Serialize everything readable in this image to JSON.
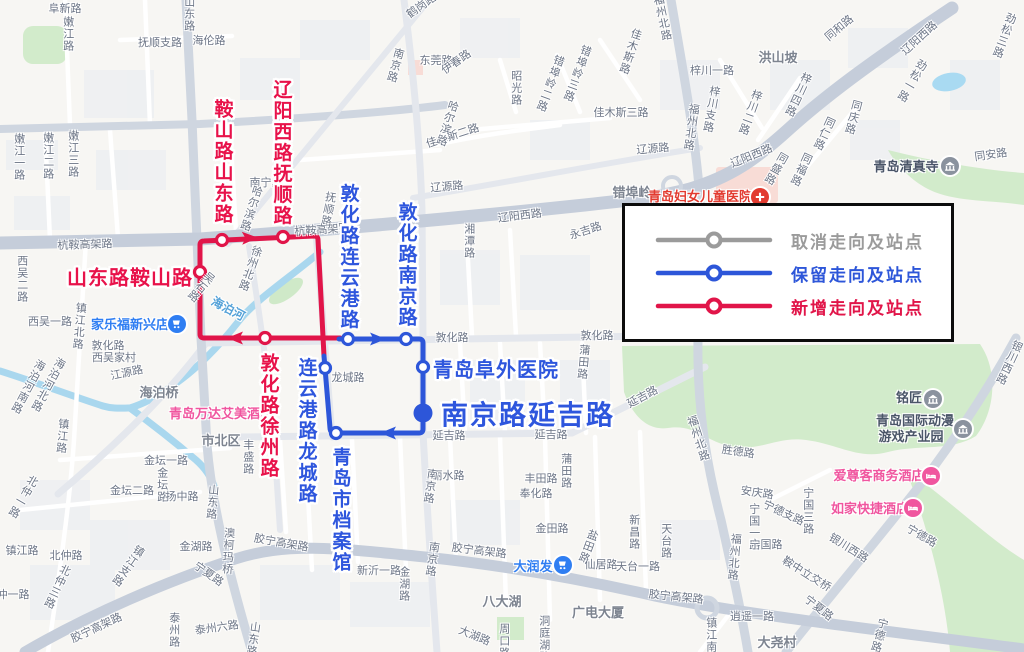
{
  "legend": {
    "items": [
      {
        "label": "取消走向及站点",
        "color": "#9b9b9b"
      },
      {
        "label": "保留走向及站点",
        "color": "#2d56d9"
      },
      {
        "label": "新增走向及站点",
        "color": "#e11549"
      }
    ]
  },
  "routes": {
    "kept": {
      "name": "保留走向",
      "color": "#2d56d9",
      "paths": [
        "M339,339 L419,339 Q423,339 423,343 L423,429 Q423,433 419,433 L336,433 Q330,433 330,428 L324,356"
      ],
      "stations": [
        [
          348,
          339
        ],
        [
          406,
          339
        ],
        [
          423,
          367
        ],
        [
          336,
          433
        ],
        [
          325,
          368
        ]
      ],
      "arrows": [
        {
          "x": 377,
          "y": 339,
          "a": 0
        },
        {
          "x": 389,
          "y": 433,
          "a": 180
        }
      ],
      "terminus": {
        "x": 423,
        "y": 413,
        "r": 9.5
      }
    },
    "added": {
      "name": "新增走向",
      "color": "#e11549",
      "paths": [
        "M340,338 L204,338 Q200,338 200,334 L200,245 Q200,241 204,241 L314,236 Q318,236 318,240 L324,356"
      ],
      "stations": [
        [
          222,
          240
        ],
        [
          283,
          237
        ],
        [
          200,
          272
        ],
        [
          265,
          338
        ]
      ],
      "arrows": [
        {
          "x": 249,
          "y": 238,
          "a": -2
        },
        {
          "x": 236,
          "y": 338,
          "a": 180
        }
      ],
      "terminus": null
    }
  },
  "route_labels": [
    {
      "t": "鞍山路山东路",
      "x": 222,
      "y": 162,
      "mode": "v",
      "cls": "red"
    },
    {
      "t": "辽阳西路抚顺路",
      "x": 281,
      "y": 153,
      "mode": "v",
      "cls": "red"
    },
    {
      "t": "山东路鞍山路",
      "x": 130,
      "y": 276,
      "mode": "h",
      "cls": "red"
    },
    {
      "t": "敦化路徐州路",
      "x": 268,
      "y": 416,
      "mode": "v",
      "cls": "red"
    },
    {
      "t": "敦化路连云港路",
      "x": 348,
      "y": 257,
      "mode": "v",
      "cls": "blue"
    },
    {
      "t": "敦化路南京路",
      "x": 406,
      "y": 265,
      "mode": "v",
      "cls": "blue"
    },
    {
      "t": "连云港路龙城路",
      "x": 306,
      "y": 431,
      "mode": "v",
      "cls": "blue"
    },
    {
      "t": "青岛市档案馆",
      "x": 340,
      "y": 510,
      "mode": "v",
      "cls": "blue"
    },
    {
      "t": "青岛阜外医院",
      "x": 496,
      "y": 368,
      "mode": "h",
      "cls": "blue"
    },
    {
      "t": "南京路延吉路",
      "x": 528,
      "y": 413,
      "mode": "h",
      "cls": "blue xl"
    }
  ],
  "pois": [
    {
      "t": "家乐福新兴店",
      "x": 130,
      "y": 325,
      "cls": "poi-blue",
      "icon": "cart-icon",
      "ix": 177,
      "iy": 324,
      "ibg": "#2f7ef2"
    },
    {
      "t": "大润发",
      "x": 533,
      "y": 567,
      "cls": "poi-blue",
      "icon": "cart-icon",
      "ix": 563,
      "iy": 565,
      "ibg": "#2f7ef2"
    },
    {
      "t": "青岛万达艾美酒店",
      "x": 221,
      "y": 414,
      "cls": "poi-pink"
    },
    {
      "t": "爱尊客商务酒店",
      "x": 879,
      "y": 476,
      "cls": "poi-pink",
      "icon": "hotel-icon",
      "ix": 931,
      "iy": 476,
      "ibg": "#f0569f"
    },
    {
      "t": "如家快捷酒店",
      "x": 870,
      "y": 509,
      "cls": "poi-pink",
      "icon": "hotel-icon",
      "ix": 913,
      "iy": 508,
      "ibg": "#f0569f"
    },
    {
      "t": "青岛妇女儿童医院",
      "x": 700,
      "y": 197,
      "cls": "poi-red",
      "icon": "hospital-icon",
      "ix": 760,
      "iy": 197,
      "ibg": "#e23b30"
    },
    {
      "t": "青岛清真寺",
      "x": 906,
      "y": 167,
      "cls": "poi-dark",
      "icon": "landmark-icon",
      "ix": 950,
      "iy": 166,
      "ibg": "#8a929e"
    },
    {
      "t": "铭匠",
      "x": 909,
      "y": 398,
      "cls": "poi-dark",
      "icon": "landmark-icon",
      "ix": 933,
      "iy": 399,
      "ibg": "#8a929e"
    },
    {
      "t": "青岛国际动漫",
      "x": 915,
      "y": 421,
      "cls": "poi-dark",
      "icon": "landmark-icon",
      "ix": 963,
      "iy": 429,
      "ibg": "#8a929e"
    },
    {
      "t": "游戏产业园",
      "x": 911,
      "y": 437,
      "cls": "poi-dark"
    }
  ],
  "map_labels": [
    {
      "t": "阜新路",
      "x": 65,
      "y": 10,
      "m": "h",
      "r": 0
    },
    {
      "t": "嫩江路",
      "x": 67,
      "y": 34,
      "m": "v",
      "r": 0
    },
    {
      "t": "山东路",
      "x": 188,
      "y": 14,
      "m": "v",
      "r": 0
    },
    {
      "t": "抚顺支路",
      "x": 160,
      "y": 44,
      "m": "h",
      "r": 0
    },
    {
      "t": "海伦路",
      "x": 209,
      "y": 42,
      "m": "h",
      "r": 0
    },
    {
      "t": "鹤岗路",
      "x": 422,
      "y": 7,
      "m": "h",
      "r": -35
    },
    {
      "t": "福州北路",
      "x": 661,
      "y": 18,
      "m": "v",
      "r": -12
    },
    {
      "t": "劲松三路",
      "x": 1003,
      "y": 35,
      "m": "v",
      "r": 20
    },
    {
      "t": "同和路",
      "x": 840,
      "y": 29,
      "m": "h",
      "r": -40
    },
    {
      "t": "辽阳西路",
      "x": 920,
      "y": 39,
      "m": "h",
      "r": -42
    },
    {
      "t": "梓川一路",
      "x": 712,
      "y": 72,
      "m": "h",
      "r": 0
    },
    {
      "t": "洪山坡",
      "x": 778,
      "y": 58,
      "m": "h",
      "r": 0,
      "cls": "big"
    },
    {
      "t": "梓川四路",
      "x": 797,
      "y": 94,
      "m": "v",
      "r": 25
    },
    {
      "t": "梓川支路",
      "x": 710,
      "y": 109,
      "m": "v",
      "r": 10
    },
    {
      "t": "梓川二路",
      "x": 749,
      "y": 112,
      "m": "v",
      "r": 20
    },
    {
      "t": "福州北路",
      "x": 690,
      "y": 127,
      "m": "v",
      "r": 8
    },
    {
      "t": "劲松一路",
      "x": 911,
      "y": 80,
      "m": "v",
      "r": 30
    },
    {
      "t": "错埠岭",
      "x": 632,
      "y": 193,
      "m": "h",
      "r": 0,
      "cls": "big"
    },
    {
      "t": "辽阳西路",
      "x": 752,
      "y": 157,
      "m": "h",
      "r": -22
    },
    {
      "t": "同庆路",
      "x": 852,
      "y": 117,
      "m": "v",
      "r": 15
    },
    {
      "t": "同仁路",
      "x": 823,
      "y": 133,
      "m": "v",
      "r": 25
    },
    {
      "t": "同安路",
      "x": 991,
      "y": 156,
      "m": "h",
      "r": -8
    },
    {
      "t": "同盛路",
      "x": 775,
      "y": 168,
      "m": "v",
      "r": 30
    },
    {
      "t": "同福路",
      "x": 800,
      "y": 169,
      "m": "v",
      "r": 25
    },
    {
      "t": "永吉路",
      "x": 586,
      "y": 232,
      "m": "h",
      "r": -18
    },
    {
      "t": "辽源路",
      "x": 447,
      "y": 188,
      "m": "h",
      "r": -5
    },
    {
      "t": "辽源路",
      "x": 653,
      "y": 150,
      "m": "h",
      "r": -5
    },
    {
      "t": "湘潭路",
      "x": 468,
      "y": 241,
      "m": "v",
      "r": 0
    },
    {
      "t": "东莞路",
      "x": 436,
      "y": 62,
      "m": "h",
      "r": 0
    },
    {
      "t": "南京路",
      "x": 394,
      "y": 65,
      "m": "v",
      "r": 15
    },
    {
      "t": "错埠岭三路",
      "x": 576,
      "y": 73,
      "m": "v",
      "r": 20
    },
    {
      "t": "错埠岭二路",
      "x": 549,
      "y": 83,
      "m": "v",
      "r": 20
    },
    {
      "t": "佳木斯路",
      "x": 629,
      "y": 51,
      "m": "v",
      "r": 18
    },
    {
      "t": "佳木斯三路",
      "x": 621,
      "y": 114,
      "m": "h",
      "r": 0
    },
    {
      "t": "佳木斯二路",
      "x": 453,
      "y": 137,
      "m": "h",
      "r": -18
    },
    {
      "t": "昭光路",
      "x": 515,
      "y": 88,
      "m": "v",
      "r": 0
    },
    {
      "t": "伊春路",
      "x": 457,
      "y": 63,
      "m": "h",
      "r": -35
    },
    {
      "t": "南宁路",
      "x": 266,
      "y": 184,
      "m": "h",
      "r": 0
    },
    {
      "t": "抚顺路",
      "x": 327,
      "y": 209,
      "m": "v",
      "r": 10
    },
    {
      "t": "哈尔滨路",
      "x": 250,
      "y": 208,
      "m": "v",
      "r": 18
    },
    {
      "t": "哈尔滨路",
      "x": 446,
      "y": 123,
      "m": "v",
      "r": 18
    },
    {
      "t": "杭鞍高架路",
      "x": 85,
      "y": 246,
      "m": "h",
      "r": -2
    },
    {
      "t": "杭鞍高架路",
      "x": 322,
      "y": 231,
      "m": "h",
      "r": -4
    },
    {
      "t": "辽阳西路",
      "x": 520,
      "y": 217,
      "m": "h",
      "r": -7
    },
    {
      "t": "敦化路",
      "x": 108,
      "y": 347,
      "m": "h",
      "r": 0
    },
    {
      "t": "西吴家村",
      "x": 114,
      "y": 359,
      "m": "h",
      "r": 0
    },
    {
      "t": "江源路",
      "x": 127,
      "y": 374,
      "m": "h",
      "r": -12
    },
    {
      "t": "海泊桥",
      "x": 159,
      "y": 393,
      "m": "h",
      "r": 0,
      "cls": "big"
    },
    {
      "t": "海泊河北路",
      "x": 47,
      "y": 384,
      "m": "v",
      "r": 28
    },
    {
      "t": "海泊河南路",
      "x": 27,
      "y": 386,
      "m": "v",
      "r": 28
    },
    {
      "t": "西吴一路",
      "x": 50,
      "y": 323,
      "m": "h",
      "r": 0
    },
    {
      "t": "西吴二路",
      "x": 21,
      "y": 279,
      "m": "v",
      "r": 0
    },
    {
      "t": "镇江北路",
      "x": 78,
      "y": 326,
      "m": "v",
      "r": 5
    },
    {
      "t": "镇江路",
      "x": 61,
      "y": 436,
      "m": "v",
      "r": 5
    },
    {
      "t": "吴石路",
      "x": 200,
      "y": 286,
      "m": "v",
      "r": 40
    },
    {
      "t": "徐州北路",
      "x": 249,
      "y": 268,
      "m": "v",
      "r": 20
    },
    {
      "t": "海泊河",
      "x": 228,
      "y": 309,
      "m": "h",
      "r": 28,
      "cls": "water"
    },
    {
      "t": "龙城路",
      "x": 348,
      "y": 379,
      "m": "h",
      "r": 0
    },
    {
      "t": "敦化路",
      "x": 452,
      "y": 339,
      "m": "h",
      "r": 0
    },
    {
      "t": "敦化路",
      "x": 597,
      "y": 337,
      "m": "h",
      "r": 0
    },
    {
      "t": "蒲田路",
      "x": 582,
      "y": 362,
      "m": "v",
      "r": 5
    },
    {
      "t": "延吉路",
      "x": 449,
      "y": 437,
      "m": "h",
      "r": 0
    },
    {
      "t": "延吉路",
      "x": 551,
      "y": 436,
      "m": "h",
      "r": 0
    },
    {
      "t": "延吉路",
      "x": 643,
      "y": 398,
      "m": "h",
      "r": -28
    },
    {
      "t": "丽水路",
      "x": 448,
      "y": 477,
      "m": "h",
      "r": 0
    },
    {
      "t": "南京路",
      "x": 429,
      "y": 486,
      "m": "v",
      "r": 8
    },
    {
      "t": "南京路",
      "x": 431,
      "y": 559,
      "m": "v",
      "r": 8
    },
    {
      "t": "胶宁高架路",
      "x": 281,
      "y": 544,
      "m": "h",
      "r": 10
    },
    {
      "t": "胶宁高架路",
      "x": 479,
      "y": 552,
      "m": "h",
      "r": 7
    },
    {
      "t": "胶宁高架路",
      "x": 676,
      "y": 598,
      "m": "h",
      "r": 6
    },
    {
      "t": "胶宁高架路",
      "x": 97,
      "y": 629,
      "m": "h",
      "r": -25
    },
    {
      "t": "澳柯玛桥",
      "x": 227,
      "y": 551,
      "m": "v",
      "r": 3
    },
    {
      "t": "宁夏路",
      "x": 208,
      "y": 575,
      "m": "h",
      "r": 35
    },
    {
      "t": "宁夏路",
      "x": 818,
      "y": 609,
      "m": "h",
      "r": 38
    },
    {
      "t": "金湖路",
      "x": 196,
      "y": 548,
      "m": "h",
      "r": 0
    },
    {
      "t": "金湖路",
      "x": 403,
      "y": 584,
      "m": "v",
      "r": 0
    },
    {
      "t": "新沂一路",
      "x": 379,
      "y": 572,
      "m": "h",
      "r": 0
    },
    {
      "t": "金坛一路",
      "x": 166,
      "y": 462,
      "m": "h",
      "r": 0
    },
    {
      "t": "金坛二路",
      "x": 132,
      "y": 492,
      "m": "h",
      "r": 0
    },
    {
      "t": "金坛路",
      "x": 161,
      "y": 485,
      "m": "v",
      "r": 0
    },
    {
      "t": "扬中路",
      "x": 182,
      "y": 498,
      "m": "h",
      "r": 0
    },
    {
      "t": "山东路",
      "x": 211,
      "y": 502,
      "m": "v",
      "r": 5
    },
    {
      "t": "山东路",
      "x": 252,
      "y": 639,
      "m": "v",
      "r": 8
    },
    {
      "t": "泰州六路",
      "x": 217,
      "y": 629,
      "m": "h",
      "r": -8
    },
    {
      "t": "泰州路",
      "x": 173,
      "y": 630,
      "m": "v",
      "r": 0
    },
    {
      "t": "镇江路",
      "x": 22,
      "y": 552,
      "m": "h",
      "r": 0
    },
    {
      "t": "北仲路",
      "x": 66,
      "y": 557,
      "m": "h",
      "r": 0
    },
    {
      "t": "北仲一路",
      "x": 22,
      "y": 496,
      "m": "v",
      "r": 30
    },
    {
      "t": "北仲三路",
      "x": 56,
      "y": 586,
      "m": "v",
      "r": 25
    },
    {
      "t": "仲一路",
      "x": 13,
      "y": 596,
      "m": "h",
      "r": 0
    },
    {
      "t": "镇江支路",
      "x": 127,
      "y": 565,
      "m": "v",
      "r": 35
    },
    {
      "t": "丰盛路",
      "x": 247,
      "y": 457,
      "m": "v",
      "r": 0
    },
    {
      "t": "市北区",
      "x": 221,
      "y": 441,
      "m": "h",
      "r": 0,
      "cls": "big"
    },
    {
      "t": "丰田路",
      "x": 541,
      "y": 480,
      "m": "h",
      "r": 0
    },
    {
      "t": "奉化路",
      "x": 536,
      "y": 495,
      "m": "h",
      "r": 0
    },
    {
      "t": "蒲田路",
      "x": 565,
      "y": 471,
      "m": "v",
      "r": 0
    },
    {
      "t": "金田路",
      "x": 552,
      "y": 530,
      "m": "h",
      "r": 0
    },
    {
      "t": "盐田路",
      "x": 587,
      "y": 546,
      "m": "v",
      "r": 20
    },
    {
      "t": "仙居路",
      "x": 601,
      "y": 566,
      "m": "h",
      "r": 0
    },
    {
      "t": "天台一路",
      "x": 638,
      "y": 568,
      "m": "h",
      "r": 0
    },
    {
      "t": "新昌路",
      "x": 633,
      "y": 532,
      "m": "v",
      "r": 0
    },
    {
      "t": "天台路",
      "x": 665,
      "y": 541,
      "m": "v",
      "r": 0
    },
    {
      "t": "八大湖",
      "x": 502,
      "y": 602,
      "m": "h",
      "r": 0,
      "cls": "big"
    },
    {
      "t": "广电大厦",
      "x": 598,
      "y": 613,
      "m": "h",
      "r": 0,
      "cls": "big"
    },
    {
      "t": "大湖路",
      "x": 474,
      "y": 637,
      "m": "h",
      "r": 22
    },
    {
      "t": "洞庭湖路",
      "x": 543,
      "y": 639,
      "m": "v",
      "r": 0
    },
    {
      "t": "周口路",
      "x": 503,
      "y": 641,
      "m": "v",
      "r": 0
    },
    {
      "t": "大尧村",
      "x": 777,
      "y": 643,
      "m": "h",
      "r": 0,
      "cls": "big"
    },
    {
      "t": "安庆路",
      "x": 757,
      "y": 494,
      "m": "h",
      "r": 8
    },
    {
      "t": "宁德支路",
      "x": 783,
      "y": 514,
      "m": "h",
      "r": 25
    },
    {
      "t": "宁国三路",
      "x": 807,
      "y": 511,
      "m": "v",
      "r": 0
    },
    {
      "t": "宁国一路",
      "x": 753,
      "y": 527,
      "m": "v",
      "r": 0
    },
    {
      "t": "宁国路",
      "x": 766,
      "y": 546,
      "m": "h",
      "r": 0
    },
    {
      "t": "福州北路",
      "x": 697,
      "y": 439,
      "m": "v",
      "r": -18
    },
    {
      "t": "福州北路",
      "x": 733,
      "y": 557,
      "m": "v",
      "r": 5
    },
    {
      "t": "胜德路",
      "x": 738,
      "y": 453,
      "m": "h",
      "r": 8
    },
    {
      "t": "银川西路",
      "x": 848,
      "y": 549,
      "m": "h",
      "r": 32
    },
    {
      "t": "鞍中立交桥",
      "x": 806,
      "y": 575,
      "m": "h",
      "r": 32
    },
    {
      "t": "宁德路",
      "x": 921,
      "y": 537,
      "m": "h",
      "r": 30
    },
    {
      "t": "宁德路",
      "x": 878,
      "y": 635,
      "m": "v",
      "r": 15
    },
    {
      "t": "镇江南路",
      "x": 710,
      "y": 641,
      "m": "v",
      "r": 0
    },
    {
      "t": "逍遥一路",
      "x": 752,
      "y": 618,
      "m": "h",
      "r": 0
    },
    {
      "t": "银川西路",
      "x": 1008,
      "y": 362,
      "m": "v",
      "r": 25
    },
    {
      "t": "嫩江一路",
      "x": 18,
      "y": 157,
      "m": "v",
      "r": 0
    },
    {
      "t": "嫩江二路",
      "x": 47,
      "y": 156,
      "m": "v",
      "r": 0
    },
    {
      "t": "嫩江三路",
      "x": 72,
      "y": 154,
      "m": "v",
      "r": 0
    }
  ]
}
